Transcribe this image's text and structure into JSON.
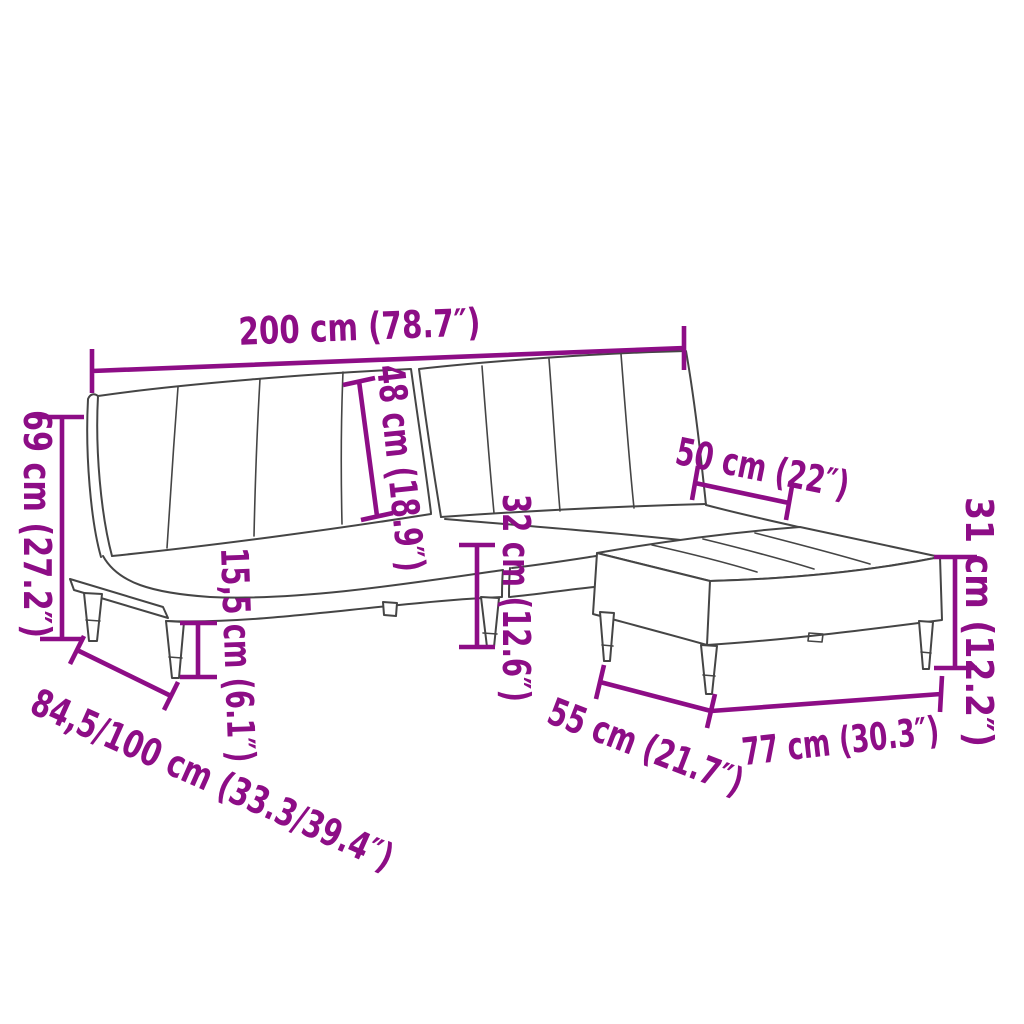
{
  "diagram": {
    "background_color": "#ffffff",
    "furniture_outline_color": "#454545",
    "dimension_color": "#8d0d86",
    "depicted_objects": [
      "sofa-bed-2-seater",
      "footstool"
    ],
    "dimensions": [
      {
        "id": "overall_width",
        "label": "200 cm (78.7″)"
      },
      {
        "id": "backrest_height",
        "label": "69 cm (27.2″)"
      },
      {
        "id": "backrest_panel_height",
        "label": "48 cm (18.9″)"
      },
      {
        "id": "seat_height",
        "label": "32 cm (12.6″)"
      },
      {
        "id": "leg_height",
        "label": "15,5 cm (6.1″)"
      },
      {
        "id": "sofa_depth_range",
        "label": "84,5/100 cm (33.3/39.4″)"
      },
      {
        "id": "footstool_top_width",
        "label": "50 cm (22″)"
      },
      {
        "id": "footstool_height",
        "label": "31 cm (12.2″)"
      },
      {
        "id": "footstool_depth",
        "label": "55 cm (21.7″)"
      },
      {
        "id": "footstool_width",
        "label": "77 cm (30.3″)"
      }
    ]
  }
}
